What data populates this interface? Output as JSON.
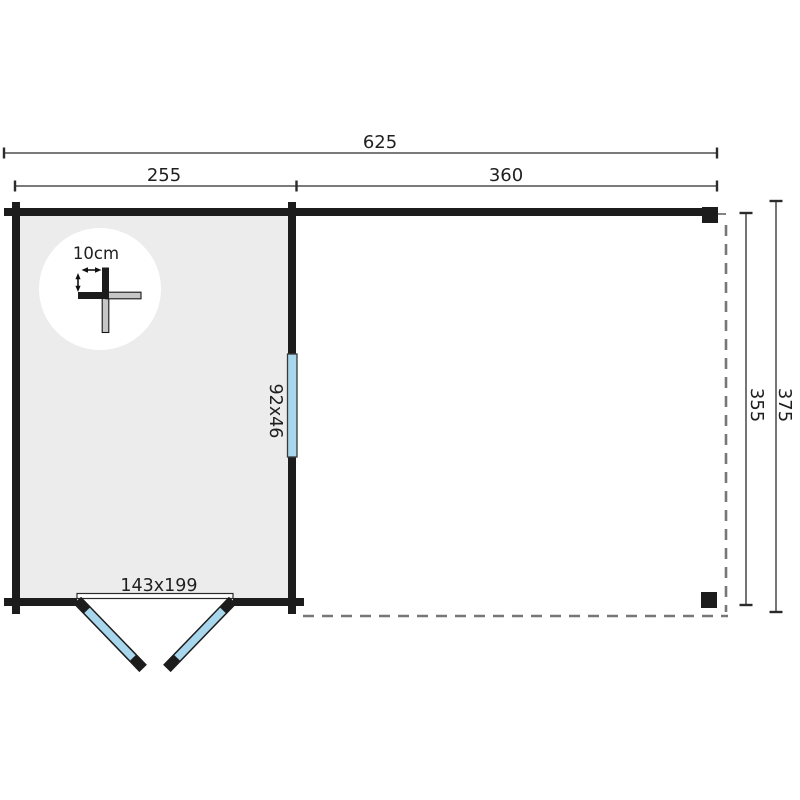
{
  "diagram": {
    "type": "garden-house-floor-plan",
    "dimensions": {
      "total_width_cm": "625",
      "cabin_width_cm": "255",
      "annex_width_cm": "360",
      "inner_depth_cm": "355",
      "total_depth_cm": "375"
    },
    "annotations": {
      "wall_thickness": "10cm",
      "window_size": "92x46",
      "door_size": "143x199"
    },
    "colors": {
      "wall_black": "#1c1c1c",
      "interior_grey": "#ececec",
      "glazing_blue": "#a8d6ec",
      "cross_arm_grey": "#c6c6c6",
      "dashed_grey": "#777777",
      "dimension_dark": "#2b2b2b",
      "background": "#ffffff"
    }
  }
}
